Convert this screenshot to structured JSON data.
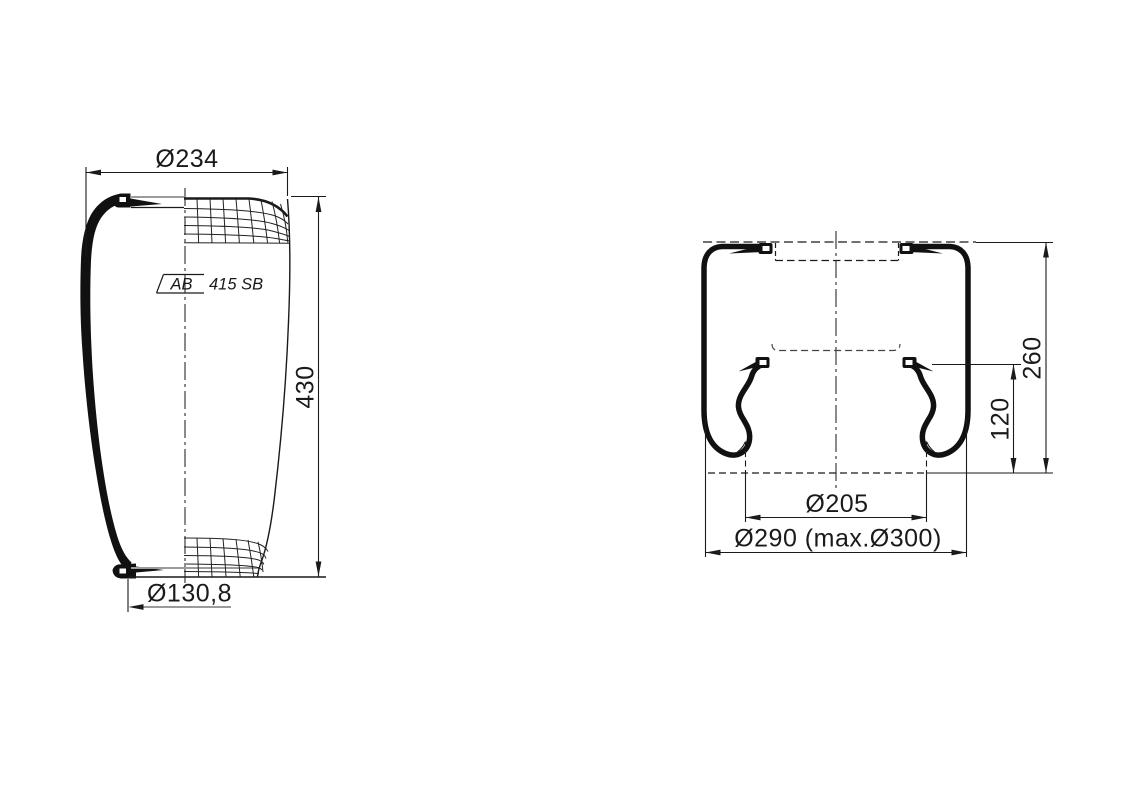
{
  "colors": {
    "ink": "#1a1a1a",
    "plate_gray": "#9b9b9b",
    "background": "#ffffff"
  },
  "left_view": {
    "dim_top_diameter": "Ø234",
    "dim_height": "430",
    "dim_bottom_diameter": "Ø130,8",
    "label_prefix": "AB",
    "label_text": "415 SB"
  },
  "right_view": {
    "dim_total_height": "260",
    "dim_roll_height": "120",
    "dim_piston_diameter": "Ø205",
    "dim_outer_diameter": "Ø290 (max.Ø300)"
  }
}
